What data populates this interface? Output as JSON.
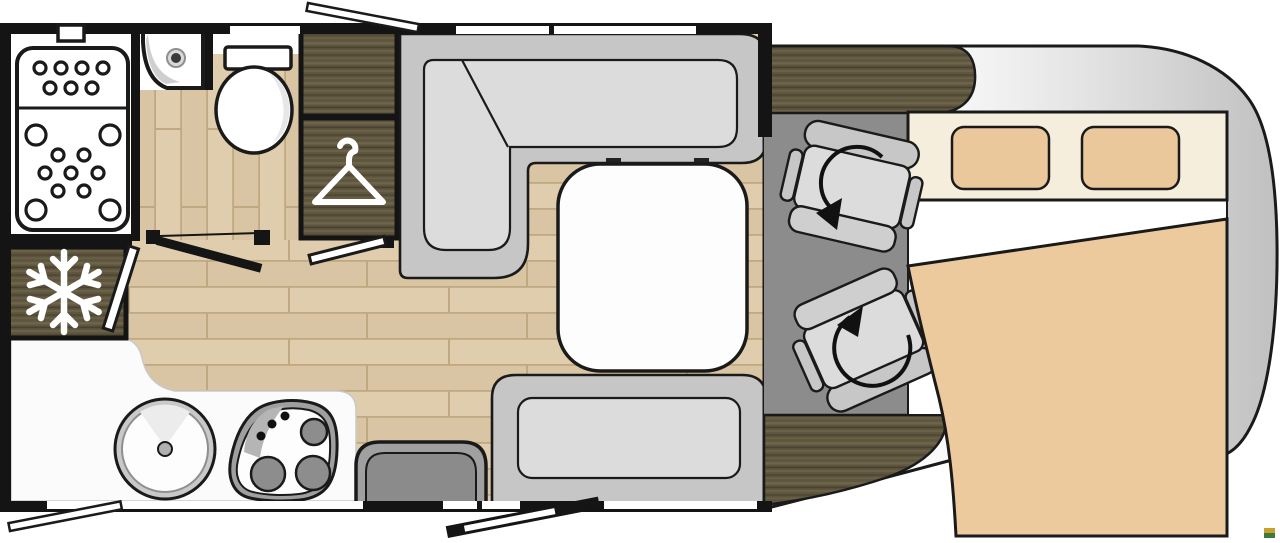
{
  "title": "motorhome-floorplan",
  "colors": {
    "page_bg": "#ffffff",
    "wall": "#141414",
    "outline": "#1a1a1a",
    "floor": "#d9c5a3",
    "floor_line": "#c0a981",
    "floor_hi": "#e4d3b4",
    "wood_dark": "#5f5640",
    "wood_hi": "#6e6449",
    "wood_lo": "#4a4230",
    "cab_floor": "#8c8c8c",
    "bench": "#c6c6c6",
    "cushion": "#dcdcdc",
    "cushion_dark": "#cfcfcf",
    "fixture_white": "#fdfdfd",
    "shade_gray": "#d8d8d8",
    "counter": "#fbfbfb",
    "sink_rim": "#c9c9c9",
    "burner": "#8d8d8d",
    "stove_rim": "#9f9f9f",
    "step_outer": "#a0a0a0",
    "step_inner": "#8b8b8b",
    "body_light": "#fbfbfb",
    "body_mid": "#e3e3e3",
    "body_dark": "#c0c0c0",
    "bed_headboard": "#f6eedd",
    "bed_tan": "#ecca9d",
    "icon_white": "#ffffff",
    "watermark_top": "#c8a02c",
    "watermark_bottom": "#3e7a3e"
  },
  "legend": {
    "vehicle": "motorhome floor plan, cab at right",
    "rooms": [
      {
        "name": "bathroom",
        "fixtures": [
          "shower-tray",
          "corner-sink",
          "toilet"
        ]
      },
      {
        "name": "wardrobe",
        "fixtures": [
          "overhead-cabinet",
          "hanging-closet"
        ]
      },
      {
        "name": "kitchen",
        "fixtures": [
          "refrigerator",
          "round-sink",
          "hob-3-burner",
          "counter"
        ]
      },
      {
        "name": "lounge",
        "fixtures": [
          "l-shaped-bench",
          "table",
          "side-bench",
          "entry-step",
          "entry-door"
        ]
      },
      {
        "name": "cab",
        "fixtures": [
          "dashboard",
          "driver-swivel-seat",
          "passenger-swivel-seat"
        ]
      },
      {
        "name": "bedroom",
        "fixtures": [
          "double-bed",
          "pillow",
          "pillow",
          "blanket"
        ]
      }
    ],
    "icons": [
      "snowflake-icon",
      "hanger-icon",
      "rotation-arrow-icon"
    ]
  }
}
